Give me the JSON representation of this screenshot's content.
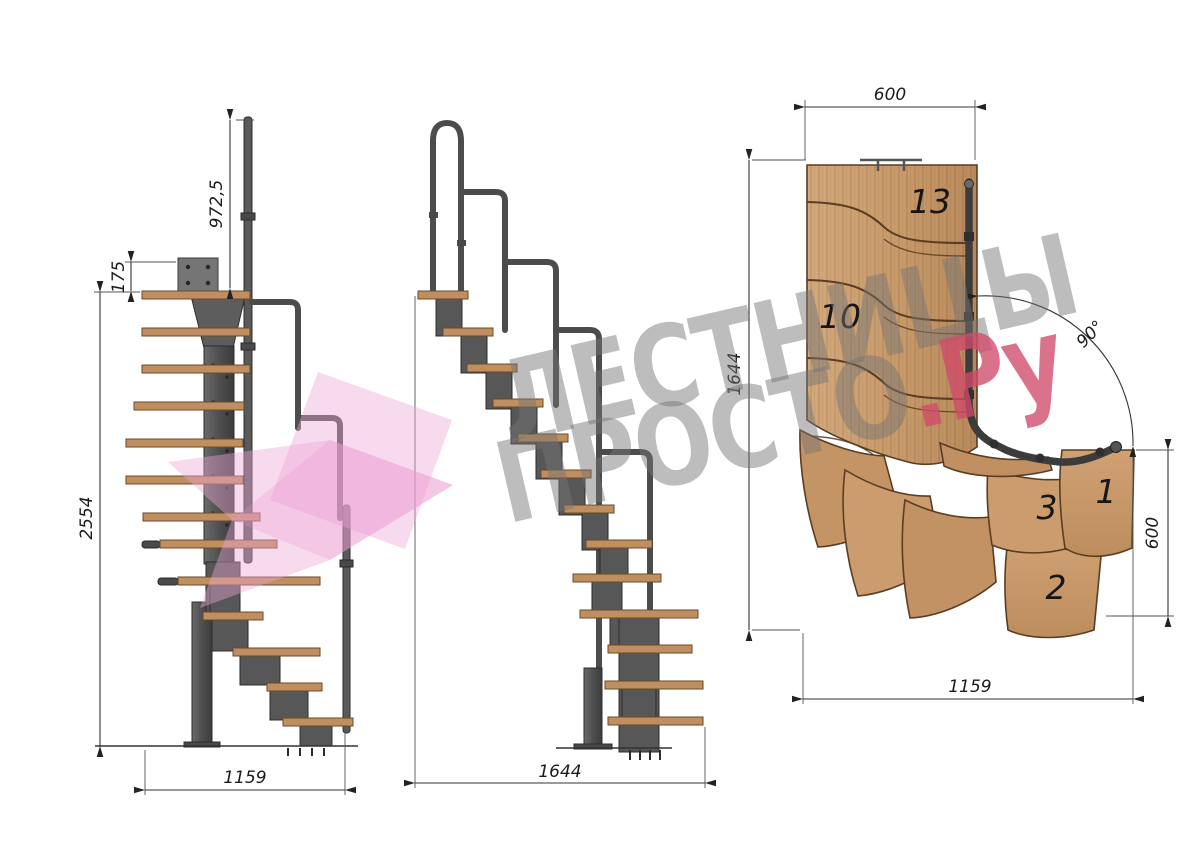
{
  "watermark": {
    "line1": "ЛЕСТНИЦЫ",
    "line2_main": "ПРОСТО",
    "line2_suffix": ".Ру"
  },
  "front_view": {
    "dim_rail_height": "972,5",
    "dim_plate_offset": "175",
    "dim_total_height": "2554",
    "dim_width": "1159"
  },
  "side_view": {
    "dim_length": "1644"
  },
  "plan_view": {
    "dim_top_width": "600",
    "dim_height": "1644",
    "dim_angle": "90°",
    "dim_exit_width": "600",
    "dim_length": "1159",
    "labels": {
      "step_13": "13",
      "step_10": "10",
      "step_3": "3",
      "step_1": "1",
      "step_2": "2"
    }
  },
  "colors": {
    "wood": "#c89a6a",
    "wood_light": "#d8ae80",
    "wood_edge": "#5a3d22",
    "metal": "#555555",
    "metal_dark": "#2e2e2e",
    "dimension_lines": "#333333",
    "logo_pink": "#efa6d6",
    "logo_red": "#cf4a6a",
    "watermark_gray": "#767676",
    "background": "#ffffff"
  }
}
